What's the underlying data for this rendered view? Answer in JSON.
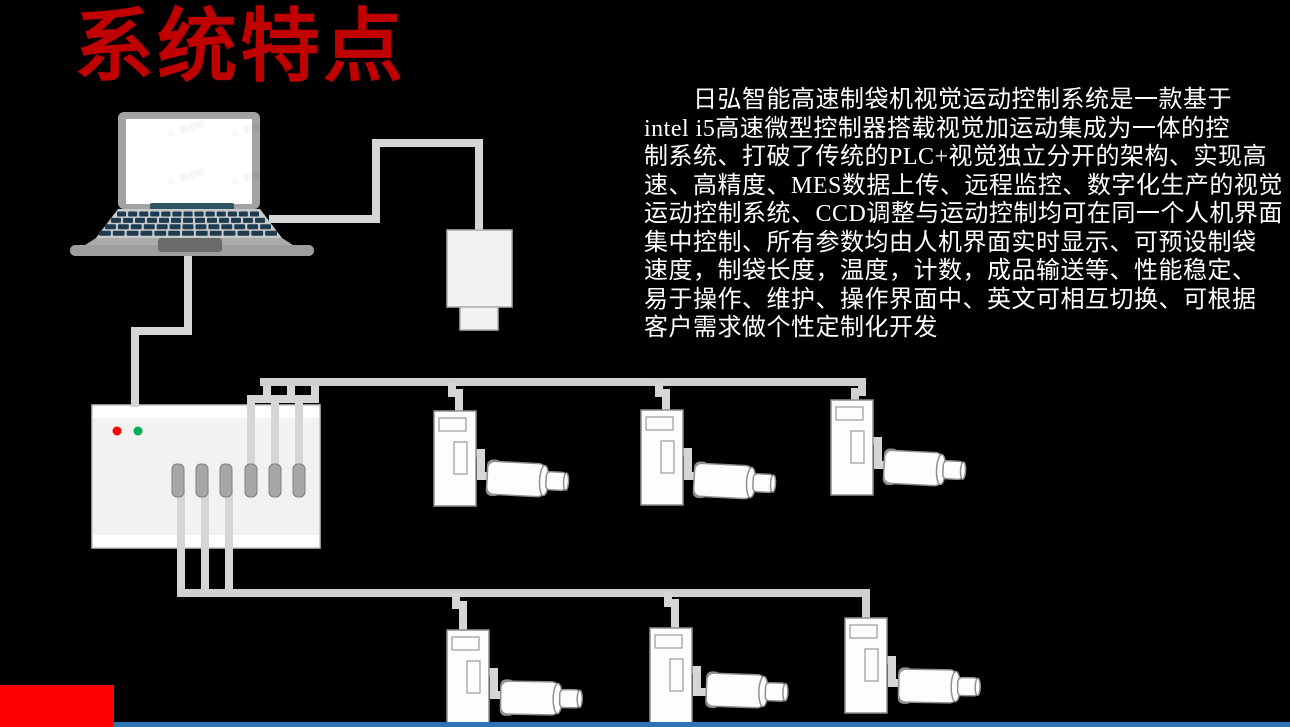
{
  "slide": {
    "title": "系统特点",
    "description": {
      "lines": [
        "　　日弘智能高速制袋机视觉运动控制系统是一款基于",
        "intel i5高速微型控制器搭载视觉加运动集成为一体的控",
        "制系统、打破了传统的PLC+视觉独立分开的架构、实现高",
        "速、高精度、MES数据上传、远程监控、数字化生产的视觉",
        "运动控制系统、CCD调整与运动控制均可在同一个人机界面",
        "集中控制、所有参数均由人机界面实时显示、可预设制袋",
        "速度，制袋长度，温度，计数，成品输送等、性能稳定、",
        "易于操作、维护、操作界面中、英文可相互切换、可根据",
        "客户需求做个性定制化开发"
      ]
    },
    "watermark": "© 摄图网",
    "diagram": {
      "controller_ports": 6,
      "servo_units_top_row": 3,
      "servo_units_bottom_row": 3,
      "controller_leds": [
        "red",
        "green"
      ]
    },
    "colors": {
      "background": "#000000",
      "title_red": "#c00000",
      "accent_block_red": "#fe0101",
      "bottom_bar_blue": "#2e74b5",
      "led_red": "#ff0000",
      "led_green": "#00b050",
      "cable_gray": "#d6d6d6"
    }
  }
}
